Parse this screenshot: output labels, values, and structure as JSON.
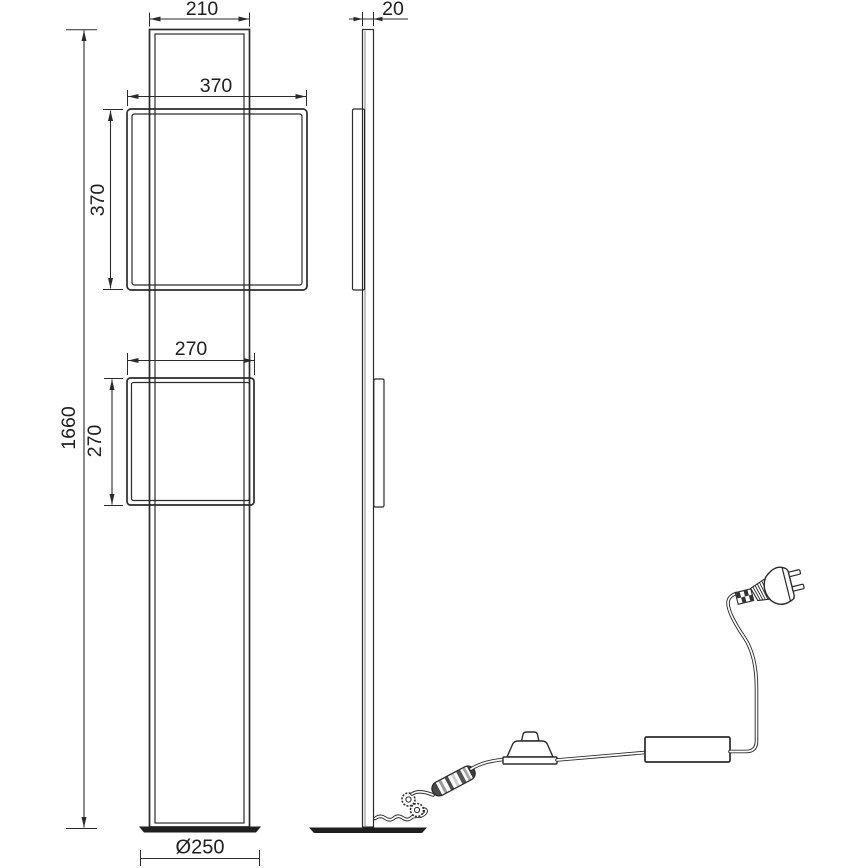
{
  "title": "floor-lamp-technical-drawing",
  "dims": {
    "front": {
      "height": "1660",
      "top_width": "210",
      "big_frame_w": "370",
      "big_frame_h": "370",
      "small_frame_w": "270",
      "small_frame_h": "270",
      "base": "Ø250"
    },
    "side": {
      "thickness": "20"
    }
  },
  "colors": {
    "line": "#2b2b2b",
    "background": "#ffffff",
    "plate": "#1f1f1f"
  }
}
